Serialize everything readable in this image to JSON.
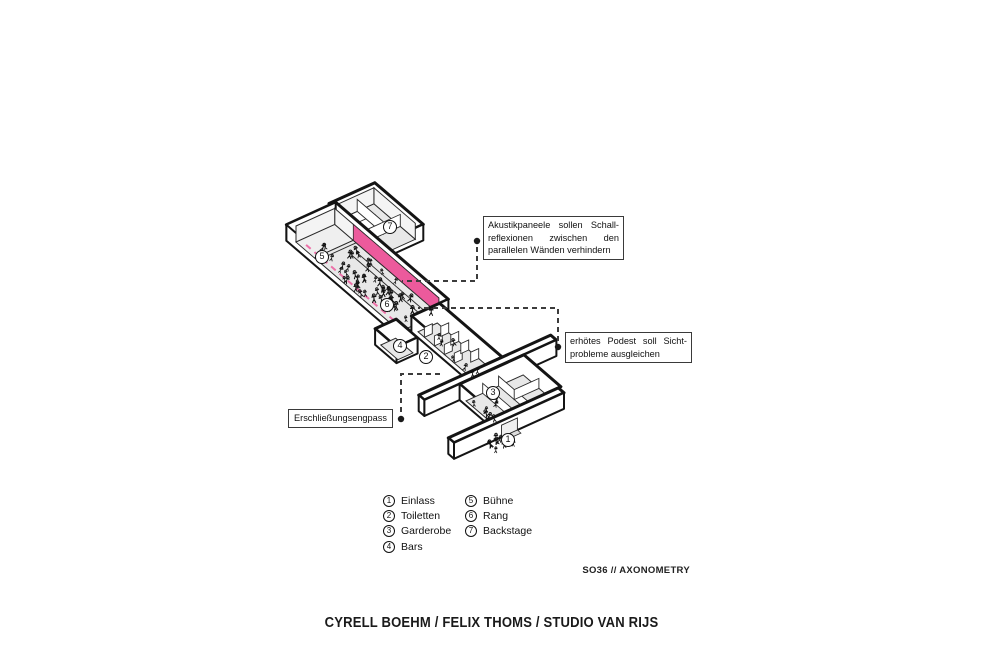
{
  "sheet": {
    "credits": "CYRELL BOEHM / FELIX THOMS / STUDIO VAN RIJS",
    "sheet_label": "SO36 // AXONOMETRY"
  },
  "colors": {
    "accent_pink": "#ec5a9c",
    "ink": "#141414",
    "floor_gray": "#e8e8e8"
  },
  "annotations": [
    {
      "id": "akustik",
      "lines": [
        "Akustikpaneele sollen Schall-",
        "reflexionen zwischen den",
        "parallelen Wänden verhindern"
      ]
    },
    {
      "id": "podest",
      "lines": [
        "erhötes Podest soll Sicht-",
        "probleme ausgleichen"
      ]
    },
    {
      "id": "engpass",
      "lines": [
        "Erschließungsengpass"
      ]
    }
  ],
  "legend": {
    "items": [
      {
        "num": "1",
        "label": "Einlass"
      },
      {
        "num": "2",
        "label": "Toiletten"
      },
      {
        "num": "3",
        "label": "Garderobe"
      },
      {
        "num": "4",
        "label": "Bars"
      },
      {
        "num": "5",
        "label": "Bühne"
      },
      {
        "num": "6",
        "label": "Rang"
      },
      {
        "num": "7",
        "label": "Backstage"
      }
    ]
  }
}
